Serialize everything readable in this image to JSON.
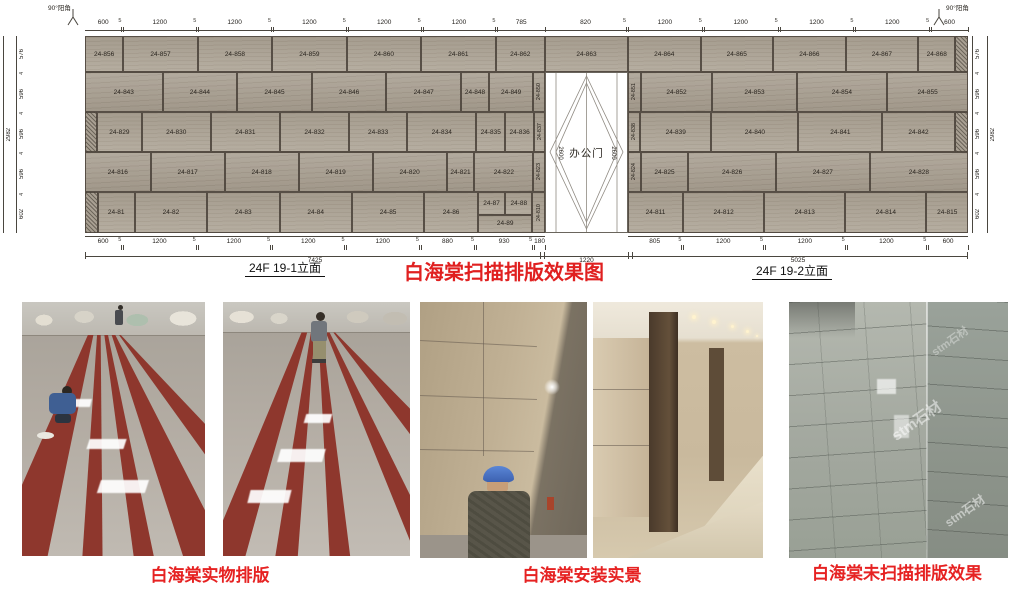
{
  "colors": {
    "accent_red": "#e02020",
    "caption_red": "#e62222",
    "stone_base": "#aaa193",
    "dim_text": "#2a2620"
  },
  "drawing": {
    "corner_label": "90°阳角",
    "door": {
      "label": "办公门",
      "side_dim": "2600",
      "width_total": "1220"
    },
    "totals": {
      "left_width": "7425",
      "right_width": "5025",
      "height_left": "2982",
      "height_right": "2982"
    },
    "elev_label_left": "24F 19-1立面",
    "elev_label_right": "24F 19-2立面",
    "title_red": "白海棠扫描排版效果图",
    "top_dims_left": [
      "600",
      "5",
      "1200",
      "5",
      "1200",
      "5",
      "1200",
      "5",
      "1200",
      "5",
      "1200",
      "5",
      "785"
    ],
    "top_dims_door": [
      "820",
      "5"
    ],
    "top_dims_right": [
      "1200",
      "5",
      "1200",
      "5",
      "1200",
      "5",
      "1200",
      "5",
      "600"
    ],
    "bottom_dims_left": [
      "600",
      "5",
      "1200",
      "5",
      "1200",
      "5",
      "1200",
      "5",
      "1200",
      "5",
      "880",
      "5",
      "930",
      "5",
      "180"
    ],
    "bottom_dims_right": [
      "805",
      "5",
      "1200",
      "5",
      "1200",
      "5",
      "1200",
      "5",
      "600"
    ],
    "vert_dims_left": [
      "576",
      "4",
      "596",
      "4",
      "596",
      "4",
      "596",
      "4",
      "602"
    ],
    "vert_dims_right": [
      "576",
      "4",
      "596",
      "4",
      "596",
      "4",
      "596",
      "4",
      "602"
    ],
    "rows": [
      {
        "hpx": 36,
        "left": [
          {
            "id": "24-856",
            "w": 600
          },
          {
            "id": "24-857",
            "w": 1200
          },
          {
            "id": "24-858",
            "w": 1200
          },
          {
            "id": "24-859",
            "w": 1200
          },
          {
            "id": "24-860",
            "w": 1200
          },
          {
            "id": "24-861",
            "w": 1200
          },
          {
            "id": "24-862",
            "w": 785
          }
        ],
        "door": [
          {
            "id": "24-863",
            "w": 820
          }
        ],
        "right": [
          {
            "id": "24-864",
            "w": 1200
          },
          {
            "id": "24-865",
            "w": 1200
          },
          {
            "id": "24-866",
            "w": 1200
          },
          {
            "id": "24-867",
            "w": 1200
          },
          {
            "id": "24-868",
            "w": 600
          },
          {
            "hatch": true,
            "w": 180
          }
        ]
      },
      {
        "hpx": 40,
        "left": [
          {
            "id": "24-843",
            "w": 1250
          },
          {
            "id": "24-844",
            "w": 1200
          },
          {
            "id": "24-845",
            "w": 1200
          },
          {
            "id": "24-846",
            "w": 1200
          },
          {
            "id": "24-847",
            "w": 1200
          },
          {
            "id": "24-848",
            "w": 430
          },
          {
            "id": "24-849",
            "w": 700
          },
          {
            "id": "24-850",
            "w": 160,
            "v": true
          }
        ],
        "right": [
          {
            "id": "24-851",
            "w": 160,
            "v": true
          },
          {
            "id": "24-852",
            "w": 1065
          },
          {
            "id": "24-853",
            "w": 1250
          },
          {
            "id": "24-854",
            "w": 1350
          },
          {
            "id": "24-855",
            "w": 1200
          }
        ]
      },
      {
        "hpx": 40,
        "left": [
          {
            "hatch": true,
            "w": 180
          },
          {
            "id": "24-829",
            "w": 760
          },
          {
            "id": "24-830",
            "w": 1200
          },
          {
            "id": "24-831",
            "w": 1200
          },
          {
            "id": "24-832",
            "w": 1200
          },
          {
            "id": "24-833",
            "w": 1000
          },
          {
            "id": "24-834",
            "w": 1200
          },
          {
            "id": "24-835",
            "w": 480
          },
          {
            "id": "24-836",
            "w": 480
          },
          {
            "id": "24-837",
            "w": 160,
            "v": true
          }
        ],
        "right": [
          {
            "id": "24-838",
            "w": 160,
            "v": true
          },
          {
            "id": "24-839",
            "w": 1100
          },
          {
            "id": "24-840",
            "w": 1350
          },
          {
            "id": "24-841",
            "w": 1300
          },
          {
            "id": "24-842",
            "w": 1115
          },
          {
            "hatch": true,
            "w": 180
          }
        ]
      },
      {
        "hpx": 40,
        "left": [
          {
            "id": "24-816",
            "w": 1060
          },
          {
            "id": "24-817",
            "w": 1200
          },
          {
            "id": "24-818",
            "w": 1200
          },
          {
            "id": "24-819",
            "w": 1200
          },
          {
            "id": "24-820",
            "w": 1200
          },
          {
            "id": "24-821",
            "w": 430
          },
          {
            "id": "24-822",
            "w": 950
          },
          {
            "id": "24-823",
            "w": 160,
            "v": true
          }
        ],
        "right": [
          {
            "id": "24-824",
            "w": 160,
            "v": true
          },
          {
            "id": "24-825",
            "w": 700
          },
          {
            "id": "24-826",
            "w": 1300
          },
          {
            "id": "24-827",
            "w": 1400
          },
          {
            "id": "24-828",
            "w": 1465
          }
        ]
      },
      {
        "hpx": 41,
        "left": [
          {
            "hatch": true,
            "w": 180
          },
          {
            "id": "24-81",
            "w": 600
          },
          {
            "id": "24-82",
            "w": 1200
          },
          {
            "id": "24-83",
            "w": 1200
          },
          {
            "id": "24-84",
            "w": 1200
          },
          {
            "id": "24-85",
            "w": 1200
          },
          {
            "id": "24-86",
            "w": 880
          },
          {
            "group": true,
            "w": 930,
            "top": [
              {
                "id": "24-87"
              },
              {
                "id": "24-88"
              }
            ],
            "bottom": {
              "id": "24-89"
            }
          },
          {
            "id": "24-810",
            "w": 180,
            "v": true
          }
        ],
        "right": [
          {
            "id": "24-811",
            "w": 805
          },
          {
            "id": "24-812",
            "w": 1200
          },
          {
            "id": "24-813",
            "w": 1200
          },
          {
            "id": "24-814",
            "w": 1200
          },
          {
            "id": "24-815",
            "w": 600
          }
        ]
      }
    ]
  },
  "photos": {
    "caption_layout": "白海棠实物排版",
    "caption_install": "白海棠安装实景",
    "caption_unscanned": "白海棠未扫描排版效果",
    "watermark": "stm石材"
  }
}
